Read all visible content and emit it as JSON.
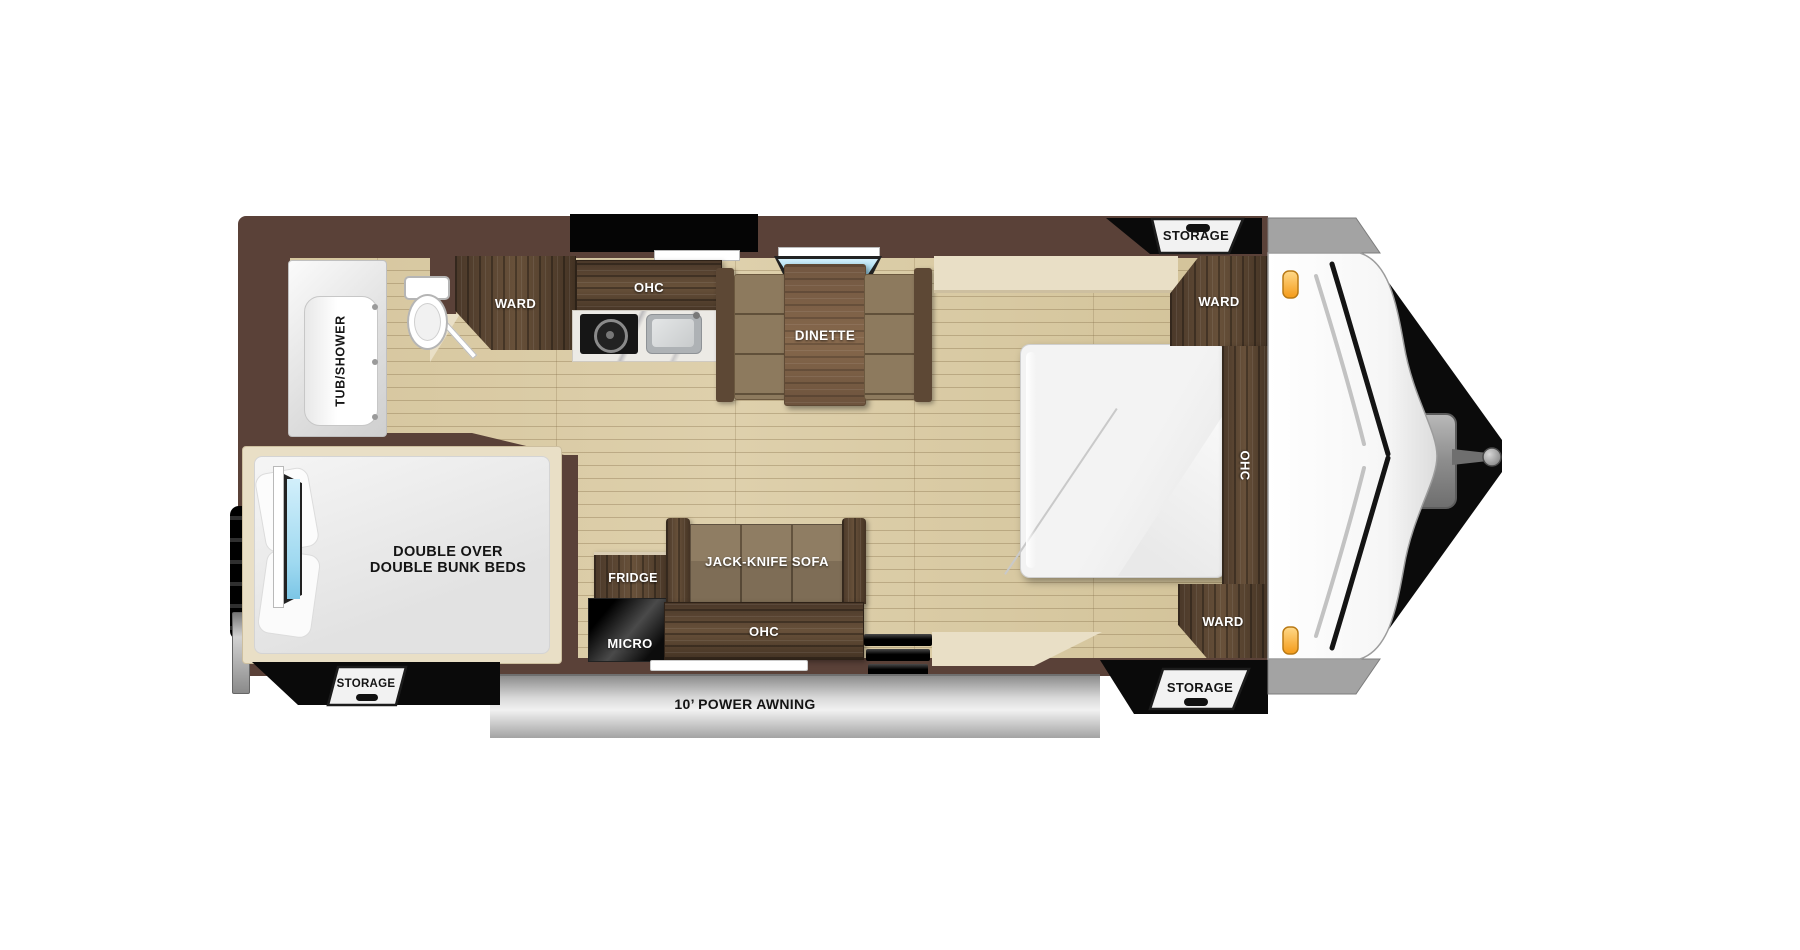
{
  "labels": {
    "tub_shower": "TUB/SHOWER",
    "ward": "WARD",
    "ohc": "OHC",
    "dinette": "DINETTE",
    "jack_knife_sofa": "JACK-KNIFE SOFA",
    "fridge": "FRIDGE",
    "micro": "MICRO",
    "bunk_line1": "DOUBLE OVER",
    "bunk_line2": "DOUBLE BUNK BEDS",
    "storage": "STORAGE",
    "awning": "10’ POWER AWNING"
  },
  "colors": {
    "wall": "#5a4138",
    "floor": "#d9caa4",
    "cabinet": "#53402f",
    "trim": "#e9dfc6",
    "window-blue": "#9fd9f0",
    "marker-light": "#f9a42d",
    "awning-gray": "#c7c7c7",
    "hatch-white": "#f2f2f2",
    "shadow-black": "#0a0a0a"
  }
}
